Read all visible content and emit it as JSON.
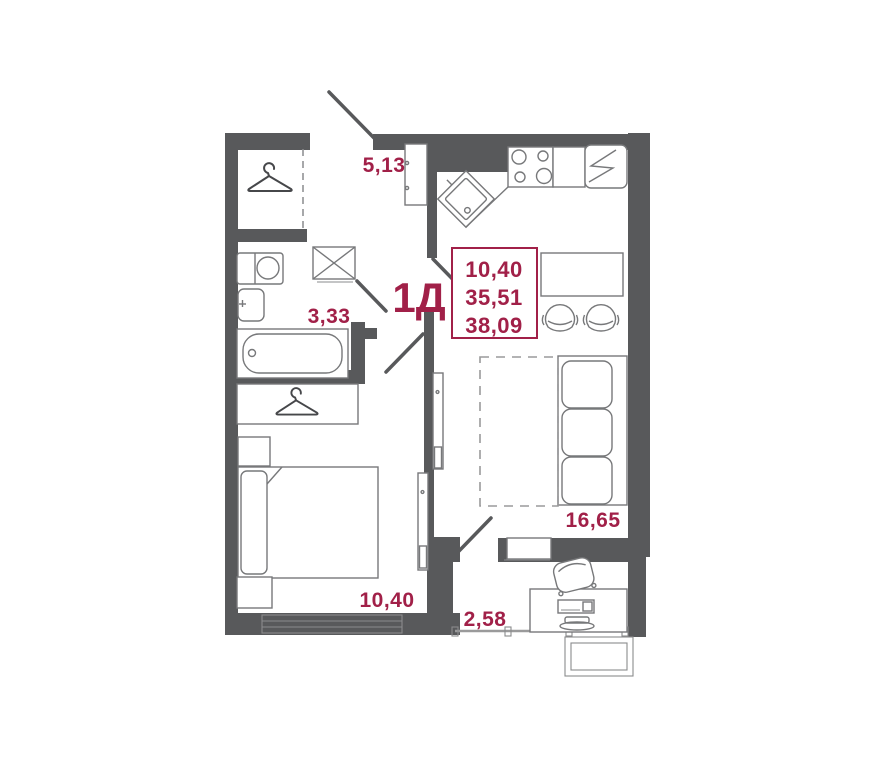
{
  "floor_plan": {
    "unit_label": "1Д",
    "summary": {
      "area_living": "10,40",
      "area_no_balcony": "35,51",
      "area_total": "38,09"
    },
    "rooms": {
      "hallway_area": "5,13",
      "bathroom_area": "3,33",
      "bedroom_area": "10,40",
      "living_room_area": "16,65",
      "balcony_area": "2,58"
    },
    "colors": {
      "wall": "#58595b",
      "accent_red": "#a12048",
      "furniture_line": "#77787a"
    }
  }
}
